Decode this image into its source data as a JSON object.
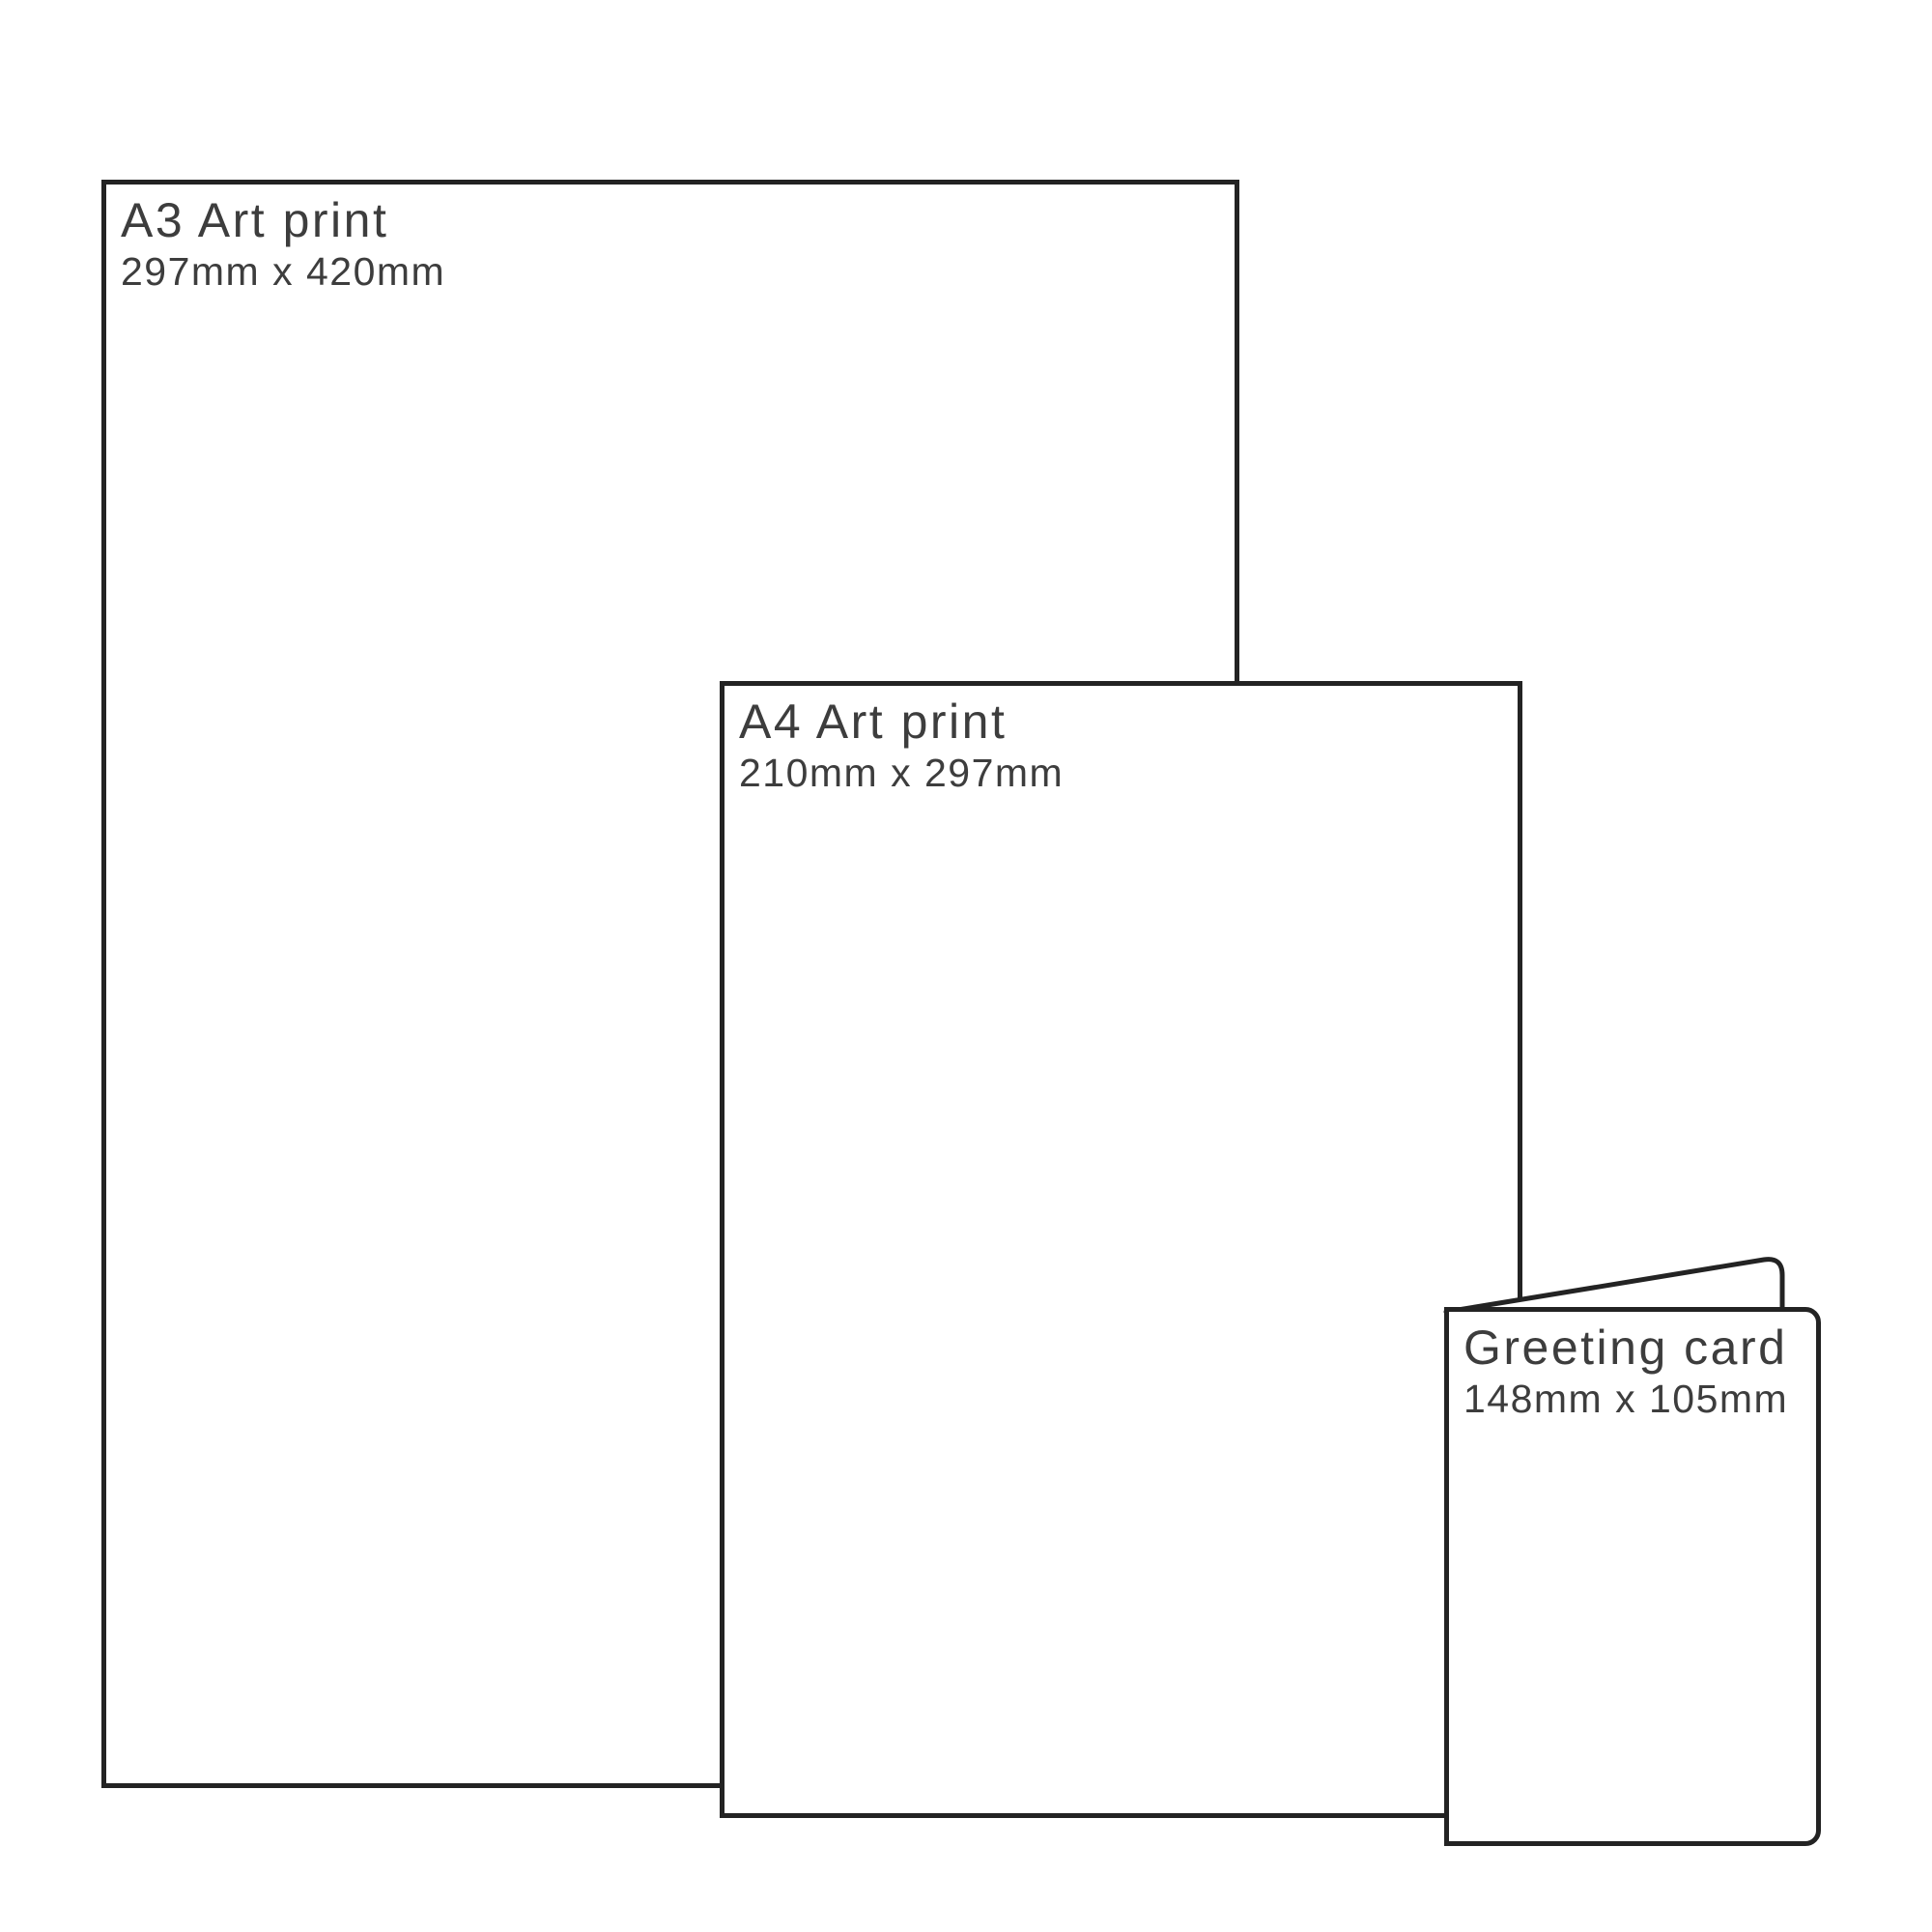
{
  "theme": {
    "line": "#232323",
    "text": "#3d3d3d",
    "bg": "#ffffff"
  },
  "items": [
    {
      "id": "a3",
      "title": "A3 Art print",
      "dimensions": "297mm x 420mm"
    },
    {
      "id": "a4",
      "title": "A4 Art print",
      "dimensions": "210mm x 297mm"
    },
    {
      "id": "card",
      "title": "Greeting card",
      "dimensions": "148mm x 105mm"
    }
  ]
}
